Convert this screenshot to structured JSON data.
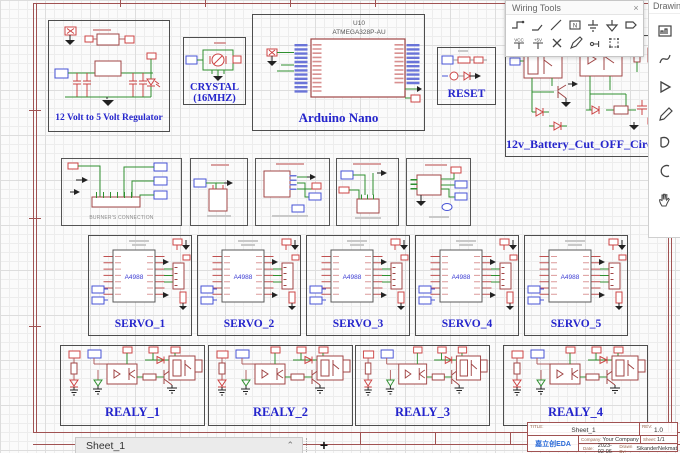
{
  "wiring_tools": {
    "title": "Wiring Tools",
    "close_glyph": "×",
    "net_label_glyph": "N",
    "vcc_label": "VCC",
    "v5_label": "+5V",
    "icons_row1": [
      "wire",
      "bus",
      "line",
      "net-label",
      "ground",
      "signal-ground",
      "net-port"
    ],
    "icons_row2": [
      "vcc-flag",
      "plus5v-flag",
      "no-connect",
      "pen",
      "voltage-probe",
      "wire-group"
    ]
  },
  "drawing_tools": {
    "title": "Drawing Tools",
    "icons": [
      "image",
      "bezier-curve",
      "arrow",
      "pencil",
      "closed-shape",
      "arc",
      "pan-hand"
    ]
  },
  "sections": {
    "regulator": {
      "label": "12 Volt to 5 Volt Regulator"
    },
    "crystal": {
      "label_line1": "CRYSTAL",
      "label_line2": "(16MHZ)"
    },
    "arduino": {
      "label": "Arduino Nano",
      "refdes": "U10",
      "part": "ATMEGA328P-AU"
    },
    "reset": {
      "label": "RESET"
    },
    "battery_cutoff": {
      "label": "12v_Battery_Cut_OFF_Circuit"
    },
    "burners": {
      "label": "BURNER'S CONNECTION"
    },
    "servos": [
      {
        "label": "SERVO_1",
        "chip": "A4988"
      },
      {
        "label": "SERVO_2",
        "chip": "A4988"
      },
      {
        "label": "SERVO_3",
        "chip": "A4988"
      },
      {
        "label": "SERVO_4",
        "chip": "A4988"
      },
      {
        "label": "SERVO_5",
        "chip": "A4988"
      }
    ],
    "relays": [
      {
        "label": "REALY_1"
      },
      {
        "label": "REALY_2"
      },
      {
        "label": "REALY_3"
      },
      {
        "label": "REALY_4"
      }
    ]
  },
  "sheet_tab": {
    "name": "Sheet_1",
    "collapse_glyph": "⌃",
    "add_label": "+"
  },
  "title_block": {
    "title_label": "TITLE:",
    "title": "Sheet_1",
    "rev_label": "REV:",
    "rev": "1.0",
    "company_label": "Company:",
    "company": "Your Company",
    "sheet_label": "Sheet:",
    "sheet": "1/1",
    "date_label": "Date:",
    "date": "2023-02-06",
    "drawn_by_label": "Drawn By:",
    "drawn_by": "SikanderNekmat",
    "logo_text": "嘉立创EDA"
  },
  "colors": {
    "wire_green": "#2f8f2f",
    "component_red": "#a04545",
    "flag_blue": "#4753d6",
    "flag_red": "#cc4444",
    "label_blue": "#2525cc",
    "frame_maroon": "#a05252"
  }
}
